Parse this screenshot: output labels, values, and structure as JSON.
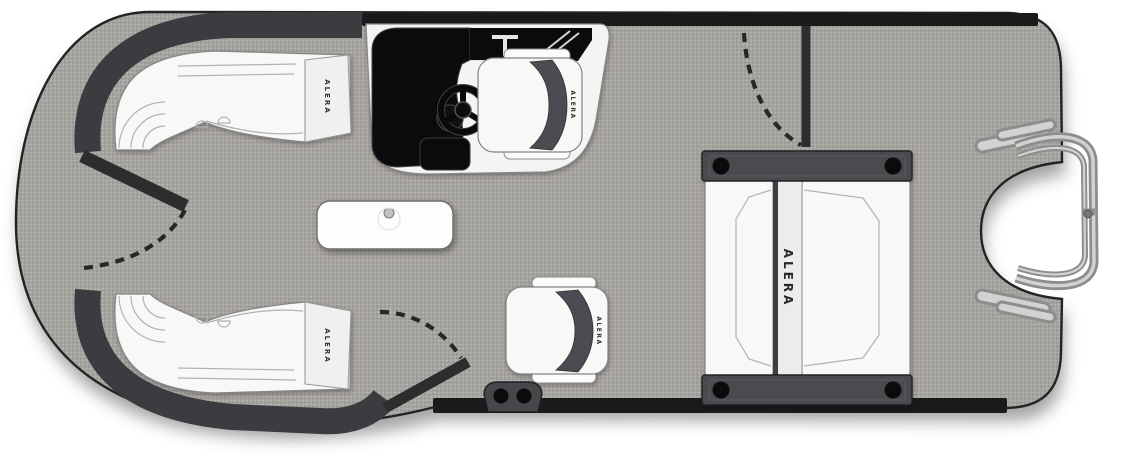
{
  "brand": "ALERA",
  "labels": {
    "bow_port_lounge": "ALERA",
    "bow_starboard_lounge": "ALERA",
    "helm_seat": "ALERA",
    "companion_seat": "ALERA",
    "aft_lounge": "ALERA"
  },
  "colors": {
    "deck": "#a8a5a1",
    "hull_outline": "#232326",
    "fence": "#3b3b40",
    "rail": "#1a1a1d",
    "gate": "#2d2d30",
    "console": "#0b0b0d",
    "seat": "#f8f8f7",
    "seat_trim": "#4b4b51",
    "hardware": "#8d8d8d"
  }
}
